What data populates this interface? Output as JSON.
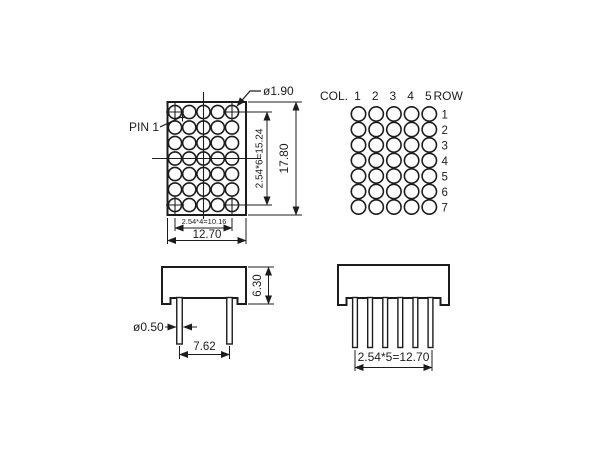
{
  "front_view": {
    "pin1_label": "PIN 1",
    "dot_diameter": "ø1.90",
    "dim_row_span": "2.54*6=15.24",
    "dim_overall_height": "17.80",
    "dim_col_span": "2.54*4=10.16",
    "dim_overall_width": "12.70",
    "grid": {
      "cols": 5,
      "rows": 7
    }
  },
  "pin_map": {
    "col_header": "COL.",
    "row_header": "ROW",
    "col_labels": [
      "1",
      "2",
      "3",
      "4",
      "5"
    ],
    "row_labels": [
      "1",
      "2",
      "3",
      "4",
      "5",
      "6",
      "7"
    ]
  },
  "side_view": {
    "dim_body_depth": "6.30",
    "pin_diameter": "ø0.50",
    "dim_pin_gap": "7.62",
    "pin_count": 2
  },
  "end_view": {
    "dim_pin_span": "2.54*5=12.70",
    "pin_count": 6
  },
  "colors": {
    "line": "#1c1c1c",
    "background": "#ffffff"
  }
}
